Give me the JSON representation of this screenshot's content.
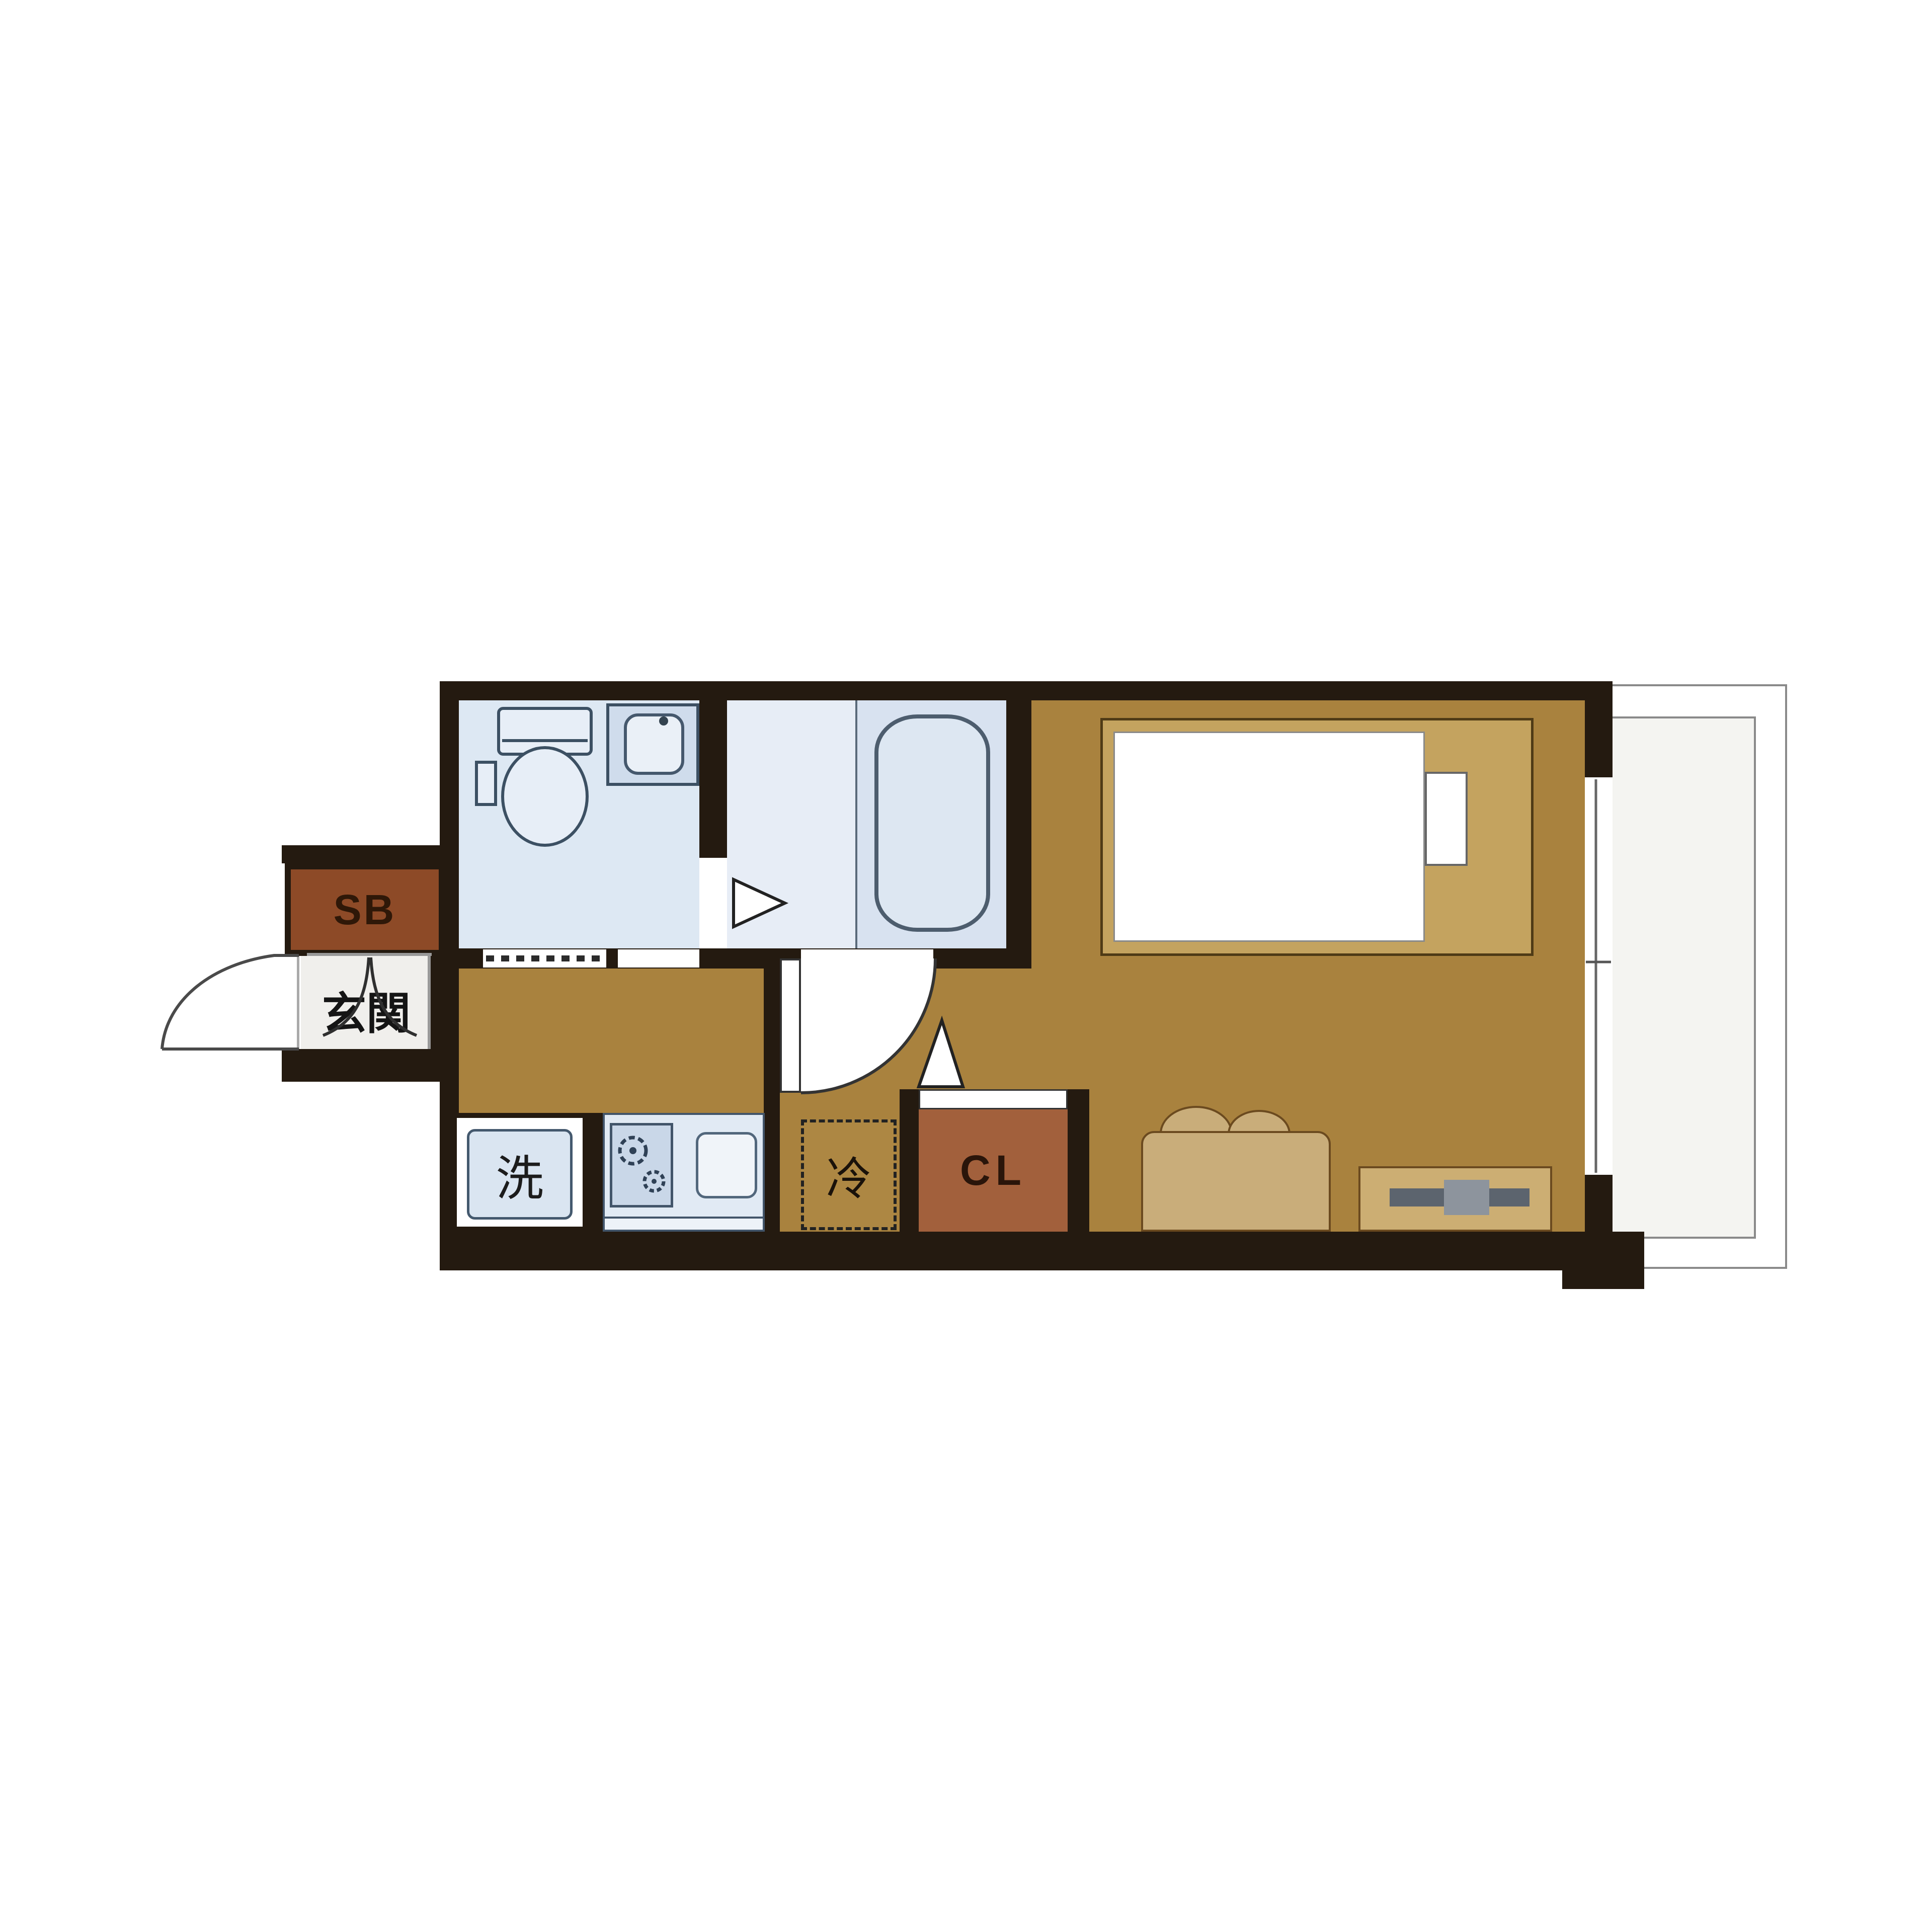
{
  "diagram": {
    "type": "apartment-floor-plan",
    "labels": {
      "shoe_box": "SB",
      "entrance": "玄関",
      "washing_machine": "洗",
      "refrigerator": "冷",
      "closet": "CL"
    },
    "rooms": [
      "entrance (玄関)",
      "toilet and vanity room",
      "unit bathroom with tub",
      "kitchen corridor",
      "main living room",
      "balcony"
    ],
    "fixtures": [
      "shoe-box",
      "entrance-door-swing",
      "entrance-step-curves",
      "toilet",
      "vanity-sink",
      "bathtub",
      "bathroom-door-triangle",
      "folding-door-dashes",
      "washing-machine-space",
      "gas-stove",
      "kitchen-sink",
      "refrigerator-space",
      "closet-sliding-door",
      "closet-door-triangle",
      "interior-door-swing",
      "bed",
      "pillow",
      "sofa",
      "tv-board",
      "tv",
      "sliding-window",
      "balcony-railing"
    ],
    "colors": {
      "wall": "#241a10",
      "floor_main": "#a9823e",
      "floor_wet": "#dde8f3",
      "floor_bath_left": "#e7edf6",
      "floor_bath_right": "#d8e2f0",
      "floor_entry": "#f0efec",
      "floor_balcony": "#f4f4f1",
      "closet_fill": "#a2603c",
      "shoe_box_fill": "#8d4a27",
      "fixture_stroke": "#3f5266",
      "railing": "#8a8a8a"
    }
  }
}
